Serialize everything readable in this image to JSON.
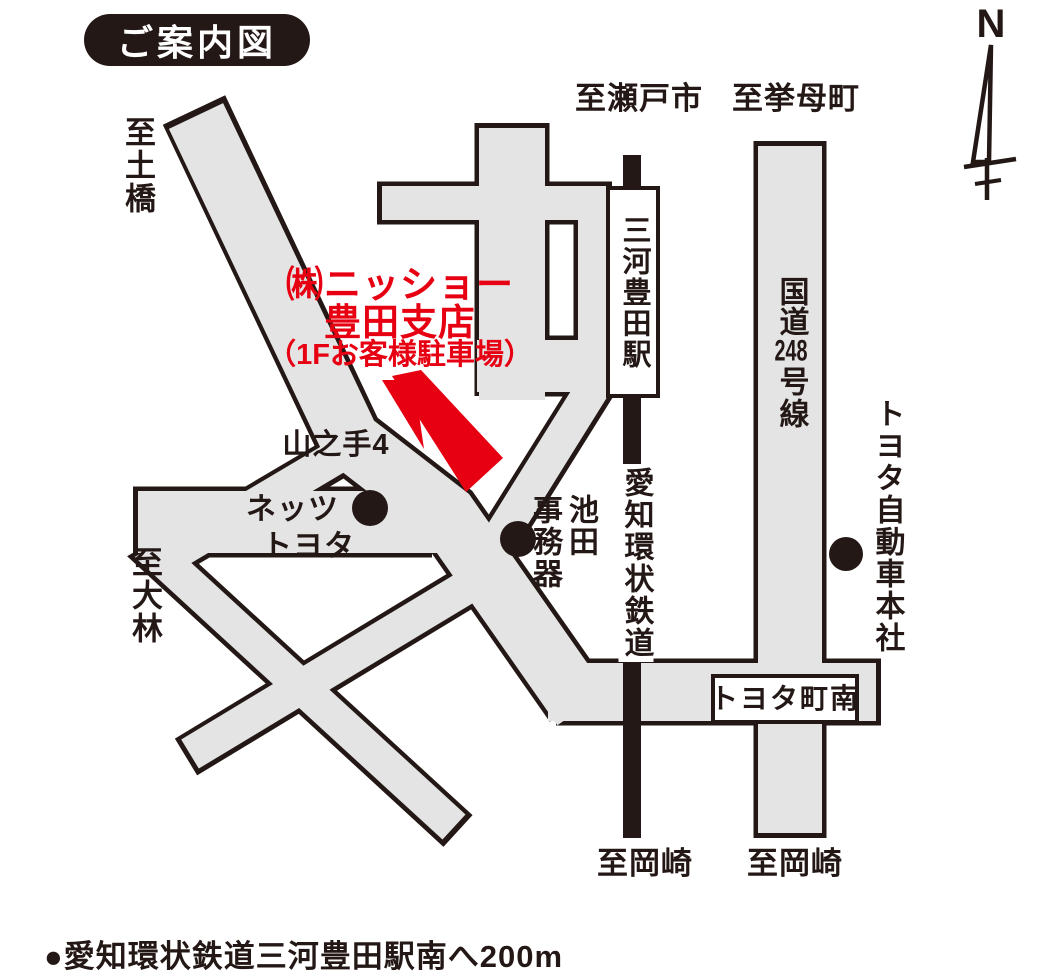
{
  "title_badge": "ご案内図",
  "compass": {
    "north_label": "N"
  },
  "colors": {
    "road_fill": "#e4e4e5",
    "outline_black": "#231815",
    "accent_red": "#e60012",
    "badge_bg": "#231815",
    "badge_text": "#ffffff"
  },
  "destination": {
    "company_line1": "㈱ニッショー",
    "company_line2": "豊田支店",
    "parking_note": "（1Fお客様駐車場）"
  },
  "railway": {
    "line_name": "愛知環状鉄道",
    "station_name": "三河豊田駅"
  },
  "roads": {
    "route248_part1": "国道",
    "route248_part2": "248",
    "route248_part3": "号線",
    "intersection_yamanote4": "山之手4",
    "intersection_toyotacho_minami": "トヨタ町南"
  },
  "directions": {
    "to_seto": "至瀬戸市",
    "to_koromo": "至挙母町",
    "to_tsuchihashi": "至土橋",
    "to_obayashi": "至大林",
    "to_okazaki_left": "至岡崎",
    "to_okazaki_right": "至岡崎"
  },
  "landmarks": {
    "netz_line1": "ネッツ",
    "netz_line2": "トヨタ",
    "ikeda_col_right": "池田",
    "ikeda_col_left": "事務器",
    "toyota_hq": "トヨタ自動車本社"
  },
  "footnote": "●愛知環状鉄道三河豊田駅南へ200m"
}
